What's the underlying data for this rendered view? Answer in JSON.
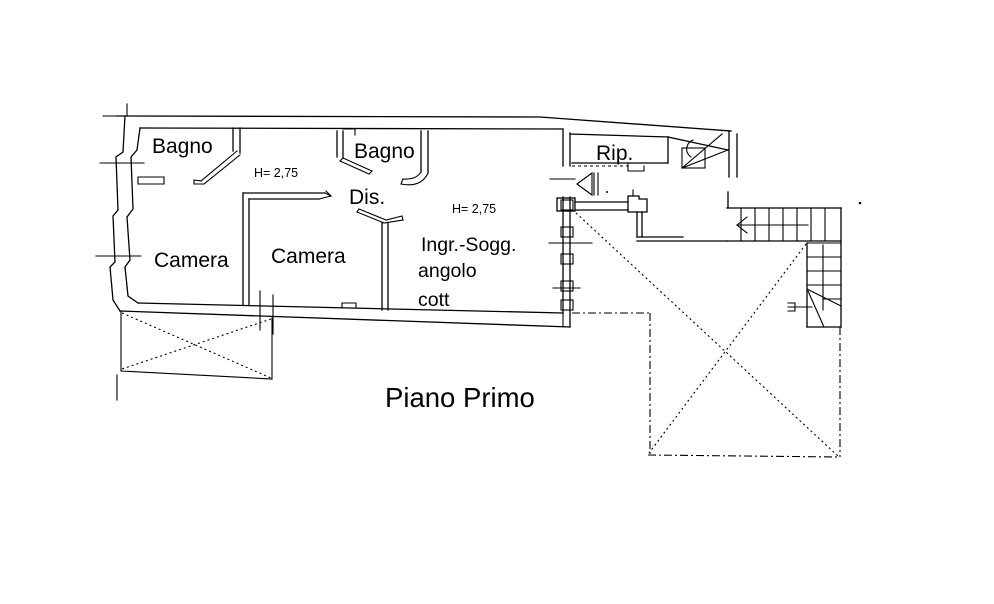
{
  "page": {
    "background_color": "#ffffff",
    "line_color": "#000000"
  },
  "title": {
    "floor_label": "Piano Primo"
  },
  "labels": {
    "bagno_left": "Bagno",
    "bagno_middle": "Bagno",
    "camera_left": "Camera",
    "camera_middle": "Camera",
    "dis": "Dis.",
    "rip": "Rip.",
    "ingr_line1": "Ingr.-Sogg.",
    "ingr_line2": "angolo",
    "ingr_line3": "cott",
    "height_left": "H= 2,75",
    "height_right": "H= 2,75"
  }
}
